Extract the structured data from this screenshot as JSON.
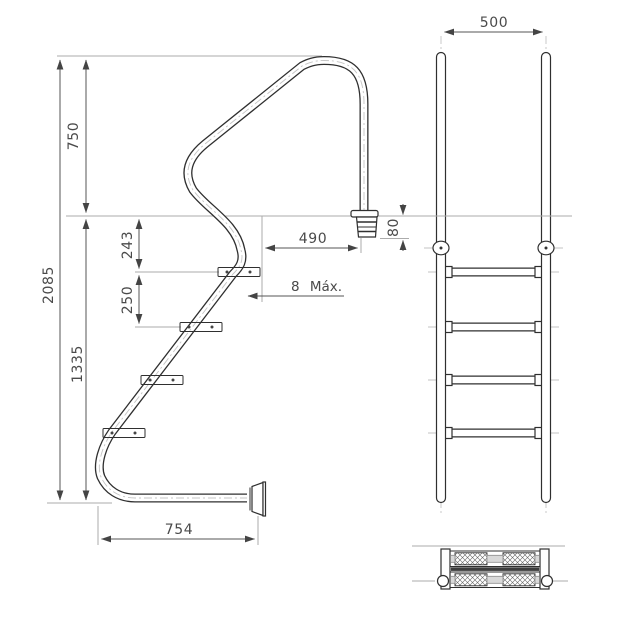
{
  "drawing": {
    "type": "technical-orthographic-drawing",
    "subject": "swimming-pool-ladder",
    "units": "mm",
    "colors": {
      "background": "#ffffff",
      "main_line": "#2f2f2f",
      "dimension_line": "#555555",
      "extension_line": "#ababab",
      "centerline": "#c4c4c4",
      "text": "#4a4a4a"
    }
  },
  "dimensions": {
    "handrail_height": "750",
    "total_height": "2085",
    "top_step_offset": "243",
    "step_spacing": "250",
    "submerged_height": "1335",
    "handrail_reach": "490",
    "wall_clearance": "8 Máx.",
    "base_length": "754",
    "anchor_depth": "80",
    "ladder_width": "500"
  },
  "structure": {
    "side_view_steps": 4,
    "front_view_rungs": 4,
    "step_y_positions": [
      "272",
      "327",
      "380",
      "433"
    ]
  }
}
